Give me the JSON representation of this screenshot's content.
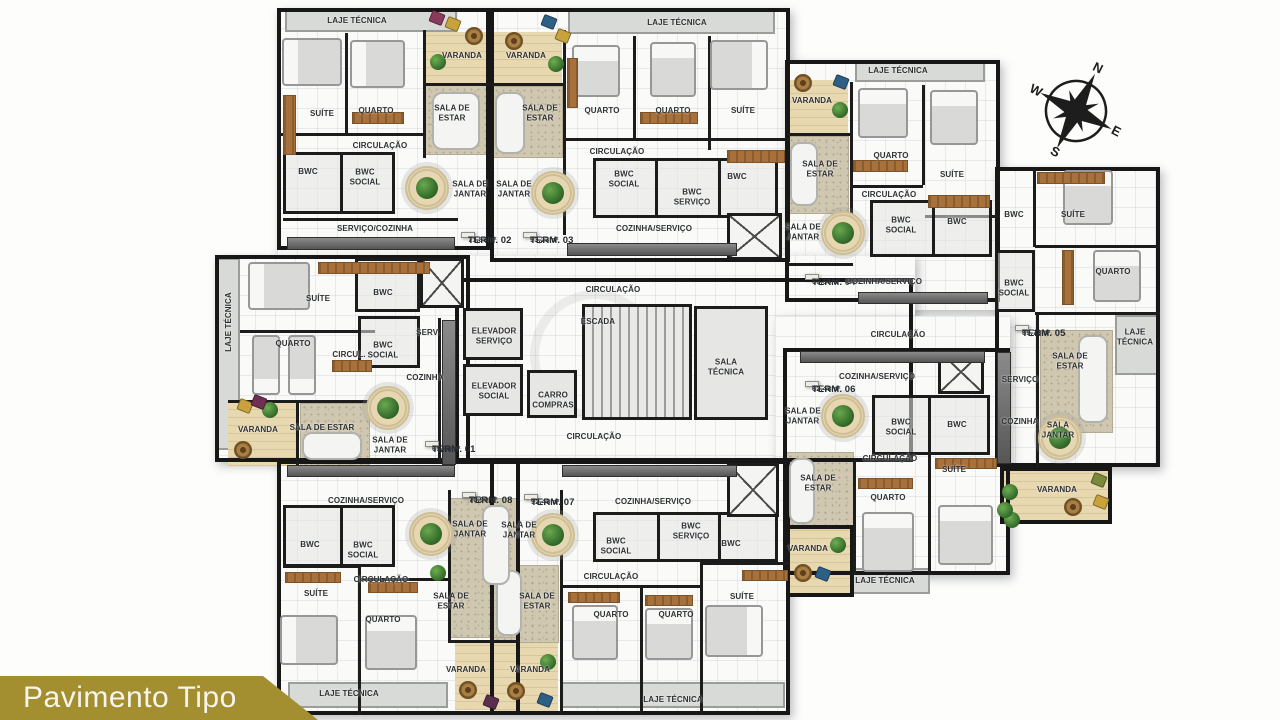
{
  "banner": {
    "title": "Pavimento Tipo"
  },
  "compass": {
    "n": "N",
    "e": "E",
    "s": "S",
    "w": "W"
  },
  "labels": [
    {
      "t": "LAJE TÉCNICA",
      "x": 357,
      "y": 21
    },
    {
      "t": "SUÍTE",
      "x": 322,
      "y": 114
    },
    {
      "t": "QUARTO",
      "x": 376,
      "y": 111
    },
    {
      "t": "VARANDA",
      "x": 462,
      "y": 56
    },
    {
      "t": "SALA DE\nESTAR",
      "x": 452,
      "y": 113
    },
    {
      "t": "CIRCULAÇÃO",
      "x": 380,
      "y": 146
    },
    {
      "t": "BWC",
      "x": 308,
      "y": 172
    },
    {
      "t": "BWC\nSOCIAL",
      "x": 365,
      "y": 177
    },
    {
      "t": "SALA DE\nJANTAR",
      "x": 470,
      "y": 189
    },
    {
      "t": "SERVIÇO/COZINHA",
      "x": 375,
      "y": 229
    },
    {
      "t": "TERM. 02",
      "sub": "71,88m²",
      "x": 468,
      "y": 235,
      "cls": "term"
    },
    {
      "t": "VARANDA",
      "x": 526,
      "y": 56
    },
    {
      "t": "LAJE TÉCNICA",
      "x": 677,
      "y": 23
    },
    {
      "t": "QUARTO",
      "x": 602,
      "y": 111
    },
    {
      "t": "QUARTO",
      "x": 673,
      "y": 111
    },
    {
      "t": "SUÍTE",
      "x": 743,
      "y": 111
    },
    {
      "t": "SALA DE\nESTAR",
      "x": 540,
      "y": 113
    },
    {
      "t": "CIRCULAÇÃO",
      "x": 617,
      "y": 152
    },
    {
      "t": "SALA DE\nJANTAR",
      "x": 514,
      "y": 189
    },
    {
      "t": "BWC\nSOCIAL",
      "x": 624,
      "y": 179
    },
    {
      "t": "BWC\nSERVIÇO",
      "x": 692,
      "y": 197
    },
    {
      "t": "BWC",
      "x": 737,
      "y": 177
    },
    {
      "t": "COZINHA/SERVIÇO",
      "x": 654,
      "y": 229
    },
    {
      "t": "TERM. 03",
      "sub": "93,23m²",
      "x": 530,
      "y": 235,
      "cls": "term"
    },
    {
      "t": "VARANDA",
      "x": 812,
      "y": 101
    },
    {
      "t": "LAJE TÉCNICA",
      "x": 898,
      "y": 71
    },
    {
      "t": "QUARTO",
      "x": 891,
      "y": 156
    },
    {
      "t": "SUÍTE",
      "x": 952,
      "y": 175
    },
    {
      "t": "SALA DE\nESTAR",
      "x": 820,
      "y": 169
    },
    {
      "t": "CIRCULAÇÃO",
      "x": 889,
      "y": 195
    },
    {
      "t": "SALA DE\nJANTAR",
      "x": 803,
      "y": 232
    },
    {
      "t": "BWC\nSOCIAL",
      "x": 901,
      "y": 225
    },
    {
      "t": "BWC",
      "x": 957,
      "y": 222
    },
    {
      "t": "TERM. 04",
      "sub": "66,56m²",
      "x": 812,
      "y": 277,
      "cls": "term"
    },
    {
      "t": "COZINHA/SERVIÇO",
      "x": 884,
      "y": 282
    },
    {
      "t": "BWC",
      "x": 1014,
      "y": 215
    },
    {
      "t": "SUÍTE",
      "x": 1073,
      "y": 215
    },
    {
      "t": "BWC\nSOCIAL",
      "x": 1014,
      "y": 288
    },
    {
      "t": "QUARTO",
      "x": 1113,
      "y": 272
    },
    {
      "t": "TERM. 05",
      "sub": "69,73m²",
      "x": 1022,
      "y": 328,
      "cls": "term"
    },
    {
      "t": "LAJE\nTÉCNICA",
      "x": 1135,
      "y": 337
    },
    {
      "t": "SALA DE\nESTAR",
      "x": 1070,
      "y": 361
    },
    {
      "t": "SERVIÇO",
      "x": 1020,
      "y": 380
    },
    {
      "t": "COZINHA",
      "x": 1020,
      "y": 422
    },
    {
      "t": "SALA\nJANTAR",
      "x": 1058,
      "y": 430
    },
    {
      "t": "VARANDA",
      "x": 1057,
      "y": 490
    },
    {
      "t": "CIRCULAÇÃO",
      "x": 613,
      "y": 290
    },
    {
      "t": "ELEVADOR\nSERVIÇO",
      "x": 494,
      "y": 336
    },
    {
      "t": "ELEVADOR\nSOCIAL",
      "x": 494,
      "y": 391
    },
    {
      "t": "CARRO\nCOMPRAS",
      "x": 553,
      "y": 400
    },
    {
      "t": "ESCADA",
      "x": 598,
      "y": 322
    },
    {
      "t": "SALA\nTÉCNICA",
      "x": 726,
      "y": 367
    },
    {
      "t": "CIRCULAÇÃO",
      "x": 594,
      "y": 437
    },
    {
      "t": "CIRCULAÇÃO",
      "x": 898,
      "y": 335
    },
    {
      "t": "LAJE TÉCNICA",
      "x": 229,
      "y": 322,
      "rot": -90
    },
    {
      "t": "SUÍTE",
      "x": 318,
      "y": 299
    },
    {
      "t": "BWC",
      "x": 383,
      "y": 293
    },
    {
      "t": "QUARTO",
      "x": 293,
      "y": 344
    },
    {
      "t": "CIRCUL.",
      "x": 349,
      "y": 355
    },
    {
      "t": "BWC\nSOCIAL",
      "x": 383,
      "y": 350
    },
    {
      "t": "SERV.",
      "x": 428,
      "y": 333
    },
    {
      "t": "COZINHA",
      "x": 425,
      "y": 378
    },
    {
      "t": "VARANDA",
      "x": 258,
      "y": 430
    },
    {
      "t": "SALA DE ESTAR",
      "x": 322,
      "y": 428
    },
    {
      "t": "SALA DE\nJANTAR",
      "x": 390,
      "y": 445
    },
    {
      "t": "TERM. 01",
      "sub": "65,66m²",
      "x": 432,
      "y": 444,
      "cls": "term"
    },
    {
      "t": "COZINHA/SERVIÇO",
      "x": 366,
      "y": 501
    },
    {
      "t": "TERM. 08",
      "sub": "70,90m²",
      "x": 469,
      "y": 495,
      "cls": "term"
    },
    {
      "t": "SALA DE\nJANTAR",
      "x": 470,
      "y": 529
    },
    {
      "t": "BWC",
      "x": 310,
      "y": 545
    },
    {
      "t": "BWC\nSOCIAL",
      "x": 363,
      "y": 550
    },
    {
      "t": "CIRCULAÇÃO",
      "x": 381,
      "y": 580
    },
    {
      "t": "SUÍTE",
      "x": 316,
      "y": 594
    },
    {
      "t": "QUARTO",
      "x": 383,
      "y": 620
    },
    {
      "t": "SALA DE\nESTAR",
      "x": 451,
      "y": 601
    },
    {
      "t": "VARANDA",
      "x": 466,
      "y": 670
    },
    {
      "t": "LAJE TÉCNICA",
      "x": 349,
      "y": 694
    },
    {
      "t": "TERM. 07",
      "sub": "92,48m²",
      "x": 531,
      "y": 497,
      "cls": "term"
    },
    {
      "t": "COZINHA/SERVIÇO",
      "x": 653,
      "y": 502
    },
    {
      "t": "SALA DE\nJANTAR",
      "x": 519,
      "y": 530
    },
    {
      "t": "BWC\nSOCIAL",
      "x": 616,
      "y": 546
    },
    {
      "t": "BWC\nSERVIÇO",
      "x": 691,
      "y": 531
    },
    {
      "t": "BWC",
      "x": 731,
      "y": 544
    },
    {
      "t": "CIRCULAÇÃO",
      "x": 611,
      "y": 577
    },
    {
      "t": "SALA DE\nESTAR",
      "x": 537,
      "y": 601
    },
    {
      "t": "QUARTO",
      "x": 611,
      "y": 615
    },
    {
      "t": "QUARTO",
      "x": 676,
      "y": 615
    },
    {
      "t": "SUÍTE",
      "x": 742,
      "y": 597
    },
    {
      "t": "VARANDA",
      "x": 530,
      "y": 670
    },
    {
      "t": "LAJE TÉCNICA",
      "x": 673,
      "y": 700
    },
    {
      "t": "TERM. 06",
      "sub": "62,48m²",
      "x": 812,
      "y": 384,
      "cls": "term"
    },
    {
      "t": "COZINHA/SERVIÇO",
      "x": 877,
      "y": 377
    },
    {
      "t": "SALA DE\nJANTAR",
      "x": 803,
      "y": 416
    },
    {
      "t": "BWC\nSOCIAL",
      "x": 901,
      "y": 427
    },
    {
      "t": "BWC",
      "x": 957,
      "y": 425
    },
    {
      "t": "CIRCULAÇÃO",
      "x": 890,
      "y": 459
    },
    {
      "t": "SALA DE\nESTAR",
      "x": 818,
      "y": 483
    },
    {
      "t": "SUÍTE",
      "x": 954,
      "y": 470
    },
    {
      "t": "QUARTO",
      "x": 888,
      "y": 498
    },
    {
      "t": "VARANDA",
      "x": 808,
      "y": 549
    },
    {
      "t": "LAJE TÉCNICA",
      "x": 885,
      "y": 581
    }
  ]
}
